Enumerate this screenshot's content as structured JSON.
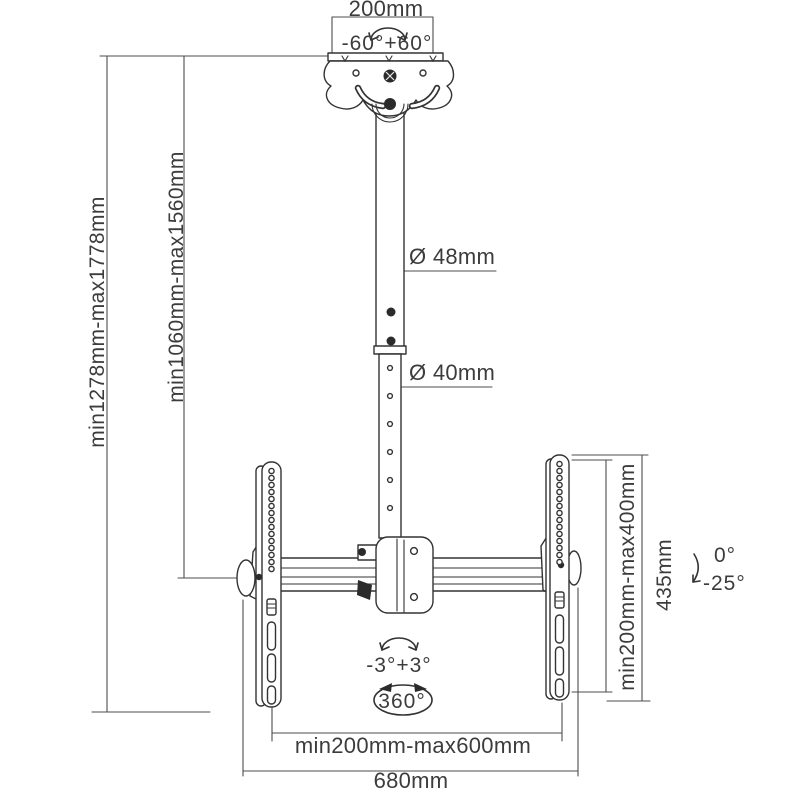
{
  "diagram": {
    "kind": "ceiling-tv-mount-dimension-drawing",
    "colors": {
      "line": "#333333",
      "dimension_line": "#4d4d4d",
      "text": "#3c3c3c",
      "background": "#ffffff"
    },
    "labels": {
      "ceiling_plate_width": "200mm",
      "swivel_range": "-60°+60°",
      "overall_height": "min1278mm-max1778mm",
      "pole_height": "min1060mm-max1560mm",
      "upper_pipe_diameter": "Ø 48mm",
      "lower_pipe_diameter": "Ø 40mm",
      "vesa_height_range": "min200mm-max400mm",
      "bracket_height": "435mm",
      "tilt_up": "0°",
      "tilt_down": "-25°",
      "level_adjust": "-3°+3°",
      "rotation": "360°",
      "vesa_width_range": "min200mm-max600mm",
      "crossbar_width": "680mm"
    }
  }
}
